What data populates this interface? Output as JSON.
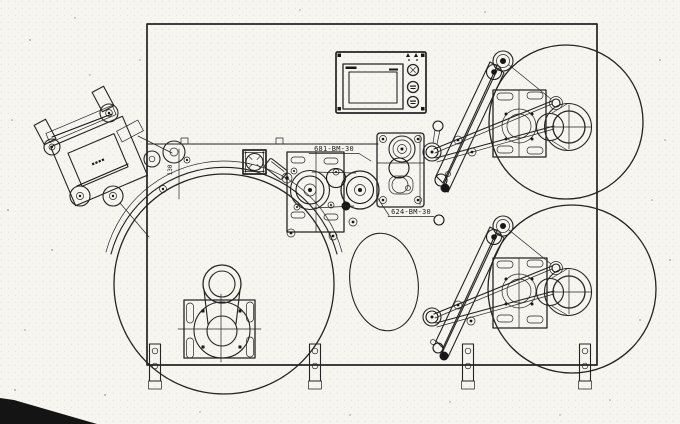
{
  "page": {
    "paper_color": "#f6f5f0",
    "ink_color": "#242424",
    "corner_shadow_color": "#141414"
  },
  "labels": {
    "part_upper": "681-BM-30",
    "part_lower": "624-BM-30",
    "dim_vertical": "130",
    "nameplate": "▪▪▪▪"
  },
  "components": [
    "machine-frame",
    "label-applicator-head",
    "hmi-control-panel",
    "unwind-reel",
    "rewind-reel-upper",
    "rewind-reel-lower",
    "dancer-arm-upper",
    "dancer-arm-lower",
    "drive-roller-cluster",
    "tension-bracket",
    "mounting-feet"
  ]
}
